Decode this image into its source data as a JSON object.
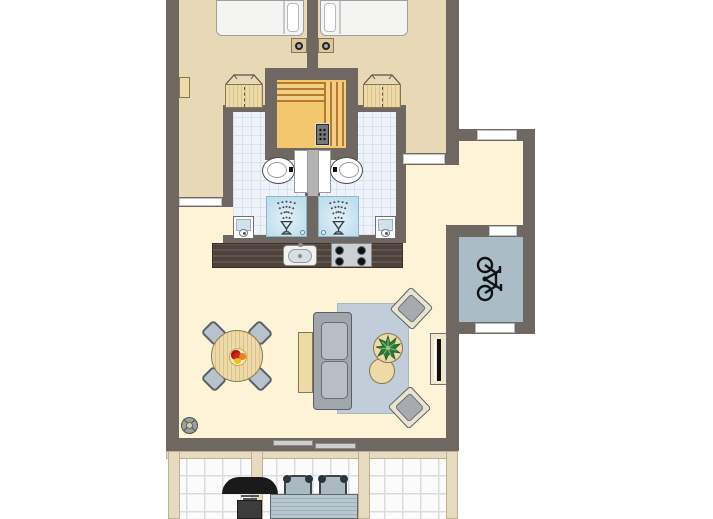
{
  "meta": {
    "type": "floor-plan",
    "description": "Top-down floor plan of a holiday apartment with two bedrooms, sauna, two bathrooms, open kitchen / living room, entrance hall, bike storage and terrace",
    "text_on_image": "none"
  },
  "colors": {
    "wall": "#6f6762",
    "floor_bedroom": "#e7d8b6",
    "floor_living": "#fdf3d7",
    "tile": "#eef3f9",
    "tile_grout": "#d9e3ee",
    "sauna_floor": "#f3c76d",
    "bench_dark": "#b87a26",
    "bench_light": "#f0cf8a",
    "storage_floor": "#aabdc7",
    "counter": "#4d423c",
    "counter_streak": "#60544d",
    "wood": "#eedaa7",
    "wood_edge": "#8a7750",
    "seat": "#b6c2cc",
    "seat_edge": "#5b6066",
    "sofa": "#a0a6ac",
    "sofa_edge": "#5a5e63",
    "cushion": "#b8bec4",
    "rug": "#c1cdd8",
    "chair_frame": "#e9e3d2",
    "post": "#e6dabf",
    "post_edge": "#bdb195",
    "terrace_tile": "#fbfbfc",
    "terrace_grout": "#d8dce1",
    "metal": "#cbd0d4"
  },
  "rooms": [
    {
      "id": "bedroom-left",
      "label": "Bedroom 1",
      "furniture": [
        "single bed",
        "nightstand with lamp",
        "wardrobe",
        "wall shelf"
      ]
    },
    {
      "id": "bedroom-right",
      "label": "Bedroom 2",
      "furniture": [
        "single bed",
        "nightstand with lamp",
        "wardrobe"
      ]
    },
    {
      "id": "sauna",
      "label": "Sauna",
      "furniture": [
        "L-shaped bench",
        "sauna heater"
      ]
    },
    {
      "id": "bathroom-left",
      "label": "Bathroom 1",
      "furniture": [
        "toilet",
        "shower",
        "washbasin"
      ]
    },
    {
      "id": "bathroom-right",
      "label": "Bathroom 2",
      "furniture": [
        "toilet",
        "shower",
        "washbasin"
      ]
    },
    {
      "id": "kitchen",
      "label": "Kitchen",
      "furniture": [
        "counter",
        "sink",
        "4-burner hob"
      ]
    },
    {
      "id": "living-room",
      "label": "Living room",
      "furniture": [
        "round dining table",
        "4 dining chairs",
        "fruit bowl",
        "sideboard",
        "sofa",
        "rug",
        "coffee table with plant",
        "side table",
        "2 armchairs",
        "TV cabinet",
        "floor lamp"
      ]
    },
    {
      "id": "hall",
      "label": "Entrance hall",
      "furniture": []
    },
    {
      "id": "storage",
      "label": "Bike storage",
      "furniture": [
        "bicycle"
      ]
    },
    {
      "id": "terrace",
      "label": "Terrace",
      "furniture": [
        "barbecue",
        "patio table",
        "2 patio chairs"
      ]
    }
  ],
  "openings": [
    {
      "id": "front-door",
      "label": "front door (hall, top wall)"
    },
    {
      "id": "door-bedroom-left",
      "label": "door bedroom 1 to living room"
    },
    {
      "id": "door-bedroom-right",
      "label": "door bedroom 2 to hall"
    },
    {
      "id": "door-storage",
      "label": "door hall to storage"
    },
    {
      "id": "window-storage",
      "label": "window storage (bottom wall)"
    },
    {
      "id": "sliding-door-terrace",
      "label": "sliding door living room to terrace"
    }
  ]
}
